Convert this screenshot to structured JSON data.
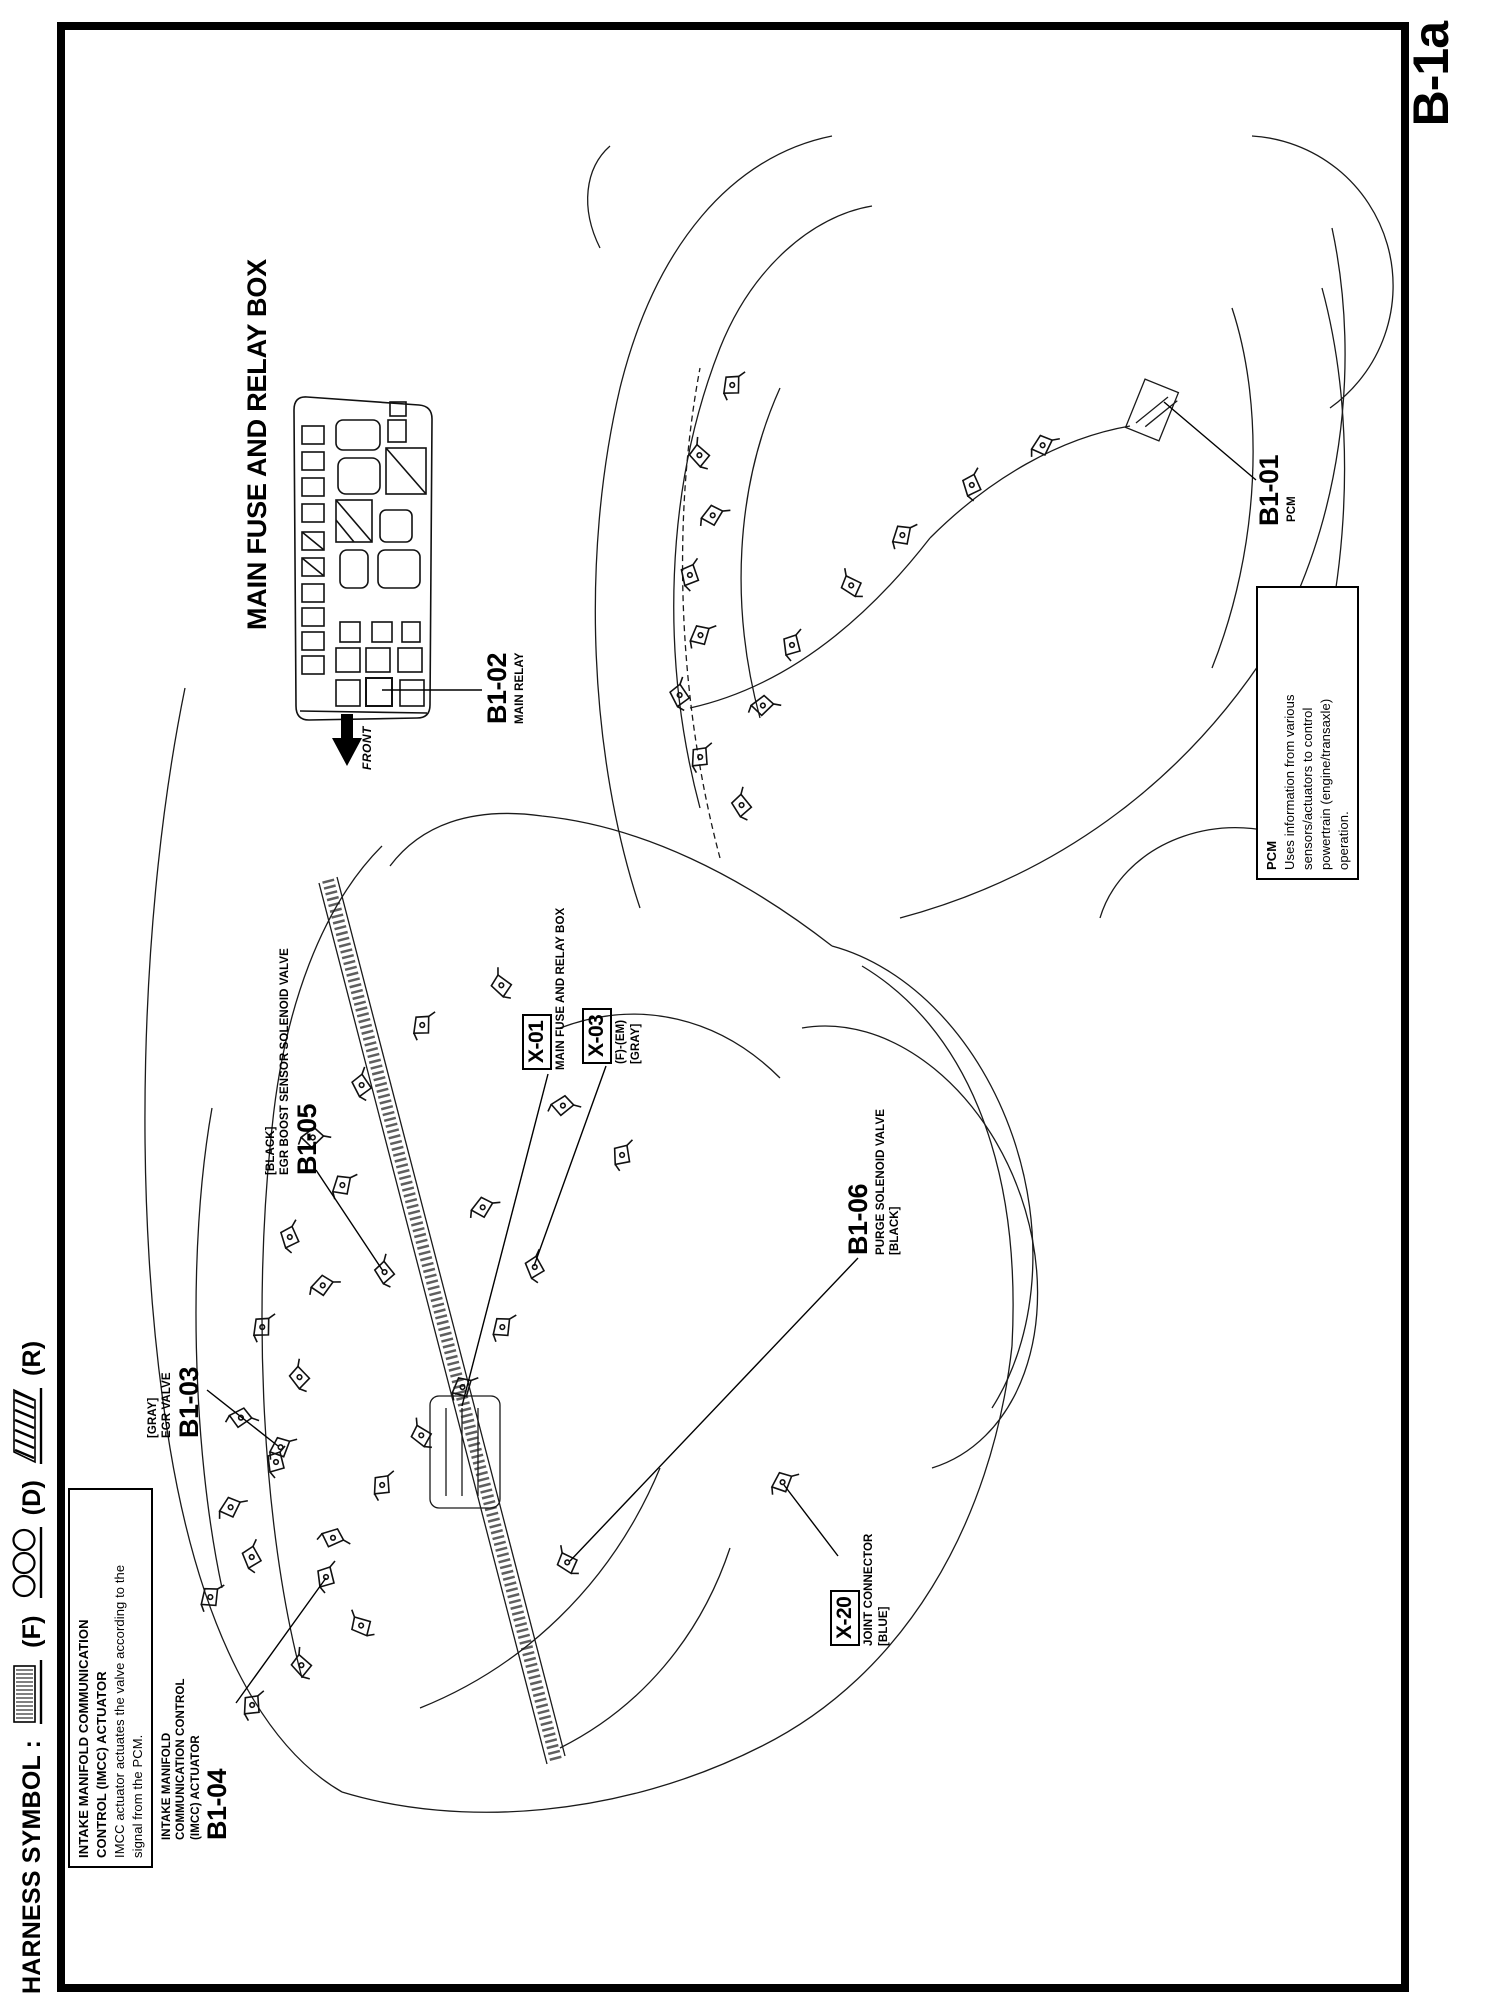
{
  "page": {
    "tab_label": "B-1a",
    "ink": "#000000",
    "paper": "#ffffff"
  },
  "legend": {
    "title": "HARNESS SYMBOL :",
    "items": [
      {
        "symbol": "dotted-shaded-box",
        "label": "(F)"
      },
      {
        "symbol": "three-circles",
        "label": "(D)"
      },
      {
        "symbol": "diagonal-hatched-box",
        "label": "(R)"
      }
    ]
  },
  "fuse_box": {
    "title": "MAIN FUSE AND RELAY BOX",
    "front_label": "FRONT",
    "callout": {
      "code": "B1-02",
      "line1": "MAIN RELAY"
    }
  },
  "notes": {
    "imcc": {
      "title1": "INTAKE MANIFOLD COMMUNICATION",
      "title2": "CONTROL (IMCC) ACTUATOR",
      "body1": "IMCC actuator actuates the valve according to the",
      "body2": "signal from the PCM."
    },
    "pcm": {
      "title": "PCM",
      "body1": "Uses information from various",
      "body2": "sensors/actuators to control",
      "body3": "powertrain (engine/transaxle)",
      "body4": "operation."
    }
  },
  "callouts": {
    "b1_04": {
      "line1": "INTAKE MANIFOLD",
      "line2": "COMMUNICATION CONTROL",
      "line3": "(IMCC) ACTUATOR",
      "code": "B1-04"
    },
    "b1_03": {
      "line1": "[GRAY]",
      "line2": "EGR VALVE",
      "code": "B1-03"
    },
    "b1_05": {
      "line1": "[BLACK]",
      "line2": "EGR BOOST SENSOR SOLENOID VALVE",
      "code": "B1-05"
    },
    "x_01": {
      "code": "X-01",
      "line1": "MAIN FUSE AND RELAY BOX"
    },
    "x_03": {
      "code": "X-03",
      "line1": "(F)-(EM)",
      "line2": "[GRAY]"
    },
    "b1_06": {
      "code": "B1-06",
      "line1": "PURGE SOLENOID VALVE",
      "line2": "[BLACK]"
    },
    "x_20": {
      "code": "X-20",
      "line1": "JOINT CONNECTOR",
      "line2": "[BLUE]"
    },
    "b1_01": {
      "code": "B1-01",
      "line1": "PCM"
    }
  }
}
